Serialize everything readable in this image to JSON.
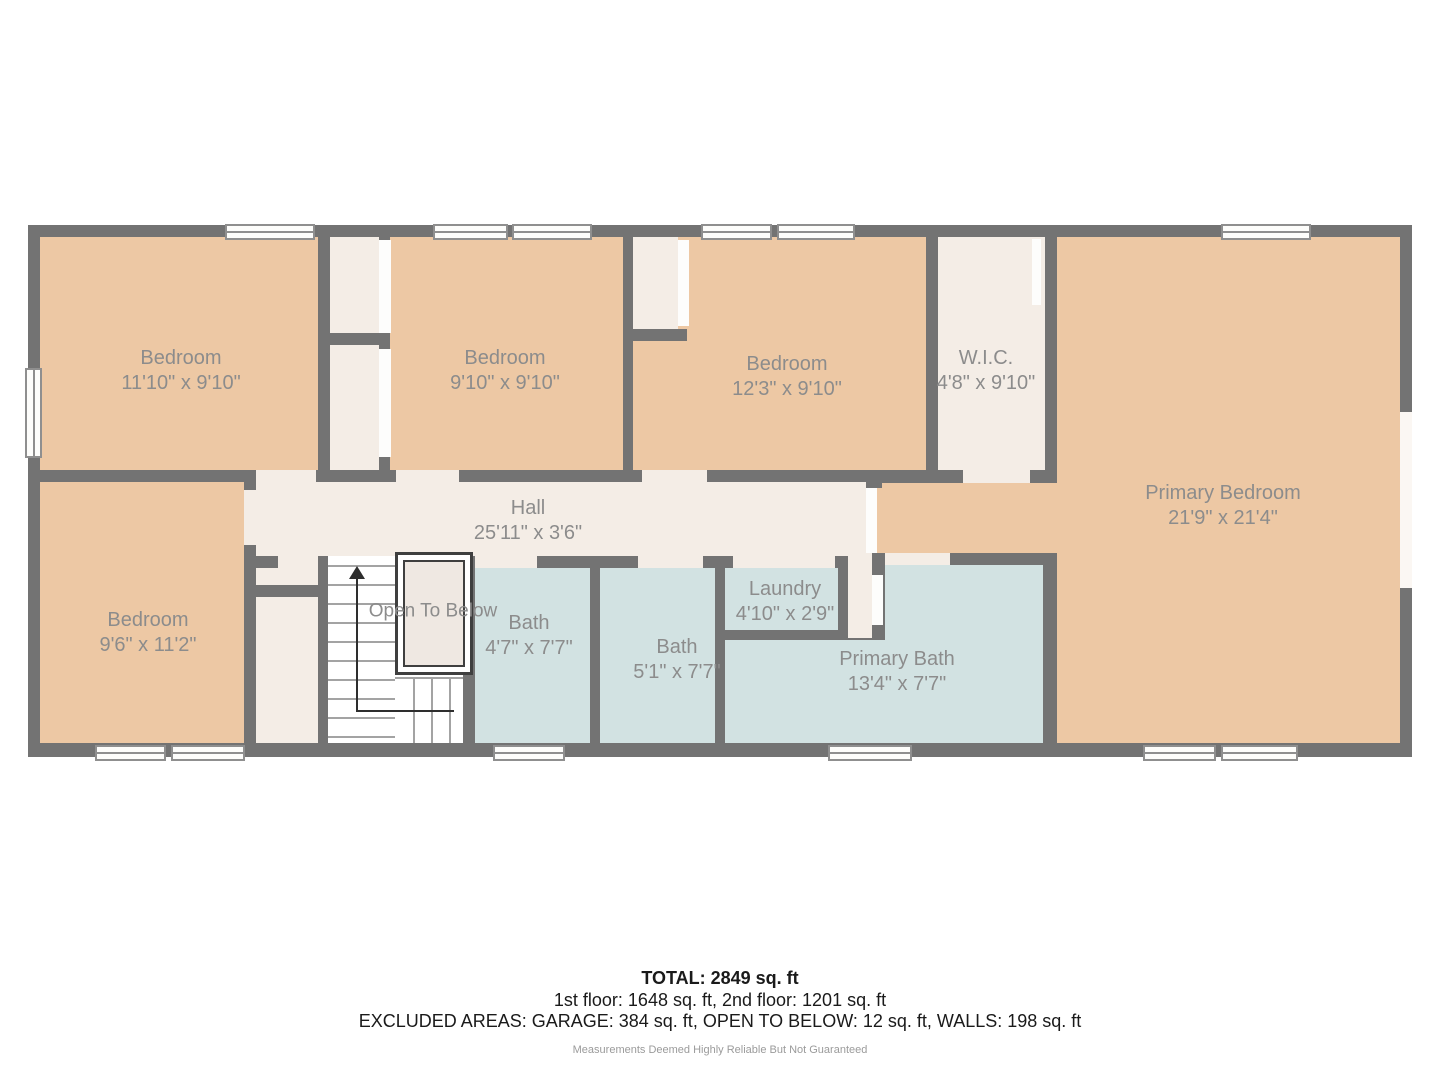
{
  "plan": {
    "rooms": [
      {
        "name": "Bedroom",
        "dims": "11'10\" x 9'10\""
      },
      {
        "name": "Bedroom",
        "dims": "9'10\" x 9'10\""
      },
      {
        "name": "Bedroom",
        "dims": "12'3\" x 9'10\""
      },
      {
        "name": "W.I.C.",
        "dims": "4'8\" x 9'10\""
      },
      {
        "name": "Primary Bedroom",
        "dims": "21'9\" x 21'4\""
      },
      {
        "name": "Hall",
        "dims": "25'11\" x 3'6\""
      },
      {
        "name": "Bedroom",
        "dims": "9'6\" x 11'2\""
      },
      {
        "name": "Open To Below",
        "dims": ""
      },
      {
        "name": "Bath",
        "dims": "4'7\" x 7'7\""
      },
      {
        "name": "Bath",
        "dims": "5'1\" x 7'7\""
      },
      {
        "name": "Laundry",
        "dims": "4'10\" x 2'9\""
      },
      {
        "name": "Primary Bath",
        "dims": "13'4\" x 7'7\""
      }
    ],
    "summary": {
      "total": "TOTAL: 2849 sq. ft",
      "floors": "1st floor: 1648 sq. ft, 2nd floor: 1201 sq. ft",
      "excluded": "EXCLUDED AREAS: GARAGE: 384 sq. ft, OPEN TO BELOW: 12 sq. ft, WALLS: 198 sq. ft",
      "disclaimer": "Measurements Deemed Highly Reliable But Not Guaranteed"
    },
    "colors": {
      "wall": "#737373",
      "bedroom_fill": "#edc8a4",
      "hall_closet_fill": "#f4ede6",
      "bath_fill": "#d2e2e2",
      "stairs_fill": "#ffffff",
      "label_text": "#8c8c8c"
    }
  }
}
